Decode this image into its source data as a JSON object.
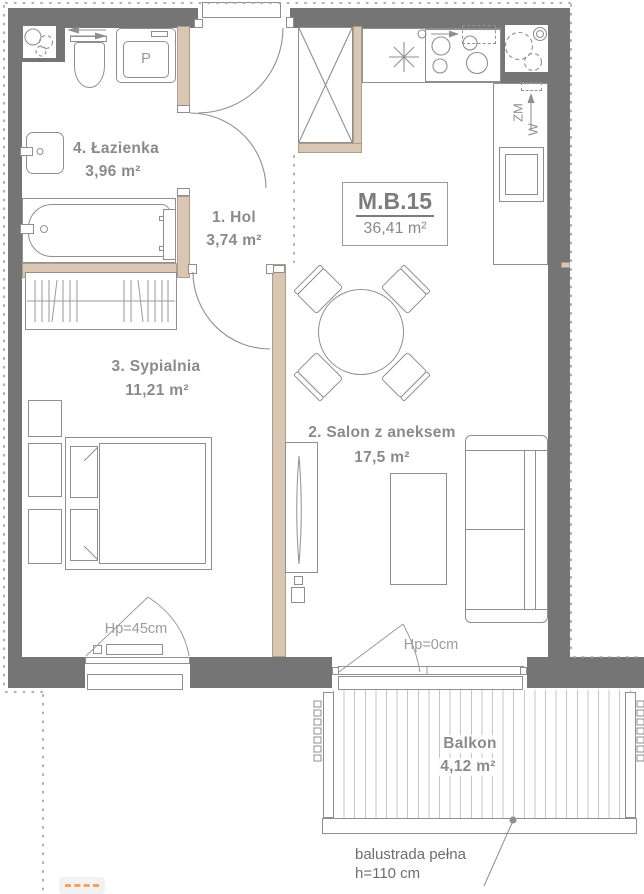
{
  "unit": {
    "code": "M.B.15",
    "area": "36,41 m²"
  },
  "rooms": [
    {
      "name": "1. Hol",
      "area": "3,74 m²"
    },
    {
      "name": "2. Salon z aneksem",
      "area": "17,5 m²"
    },
    {
      "name": "3. Sypialnia",
      "area": "11,21 m²"
    },
    {
      "name": "4. Łazienka",
      "area": "3,96 m²"
    },
    {
      "name": "Balkon",
      "area": "4,12 m²"
    }
  ],
  "annotations": {
    "bedroom_window_sill": "Hp=45cm",
    "balcony_door_sill": "Hp=0cm",
    "balustrade_line1": "balustrada pełna",
    "balustrade_line2": "h=110 cm"
  },
  "symbols": {
    "washing_machine": "P",
    "riser_top": "ZM",
    "riser_bottom": "W"
  },
  "colors": {
    "wall": "#757575",
    "partition": "#d9c7b4",
    "outline": "#8f8f8f",
    "text": "#8a8a8a",
    "annotation": "#9b9b9b",
    "orange_accent": "#f2a35c"
  }
}
